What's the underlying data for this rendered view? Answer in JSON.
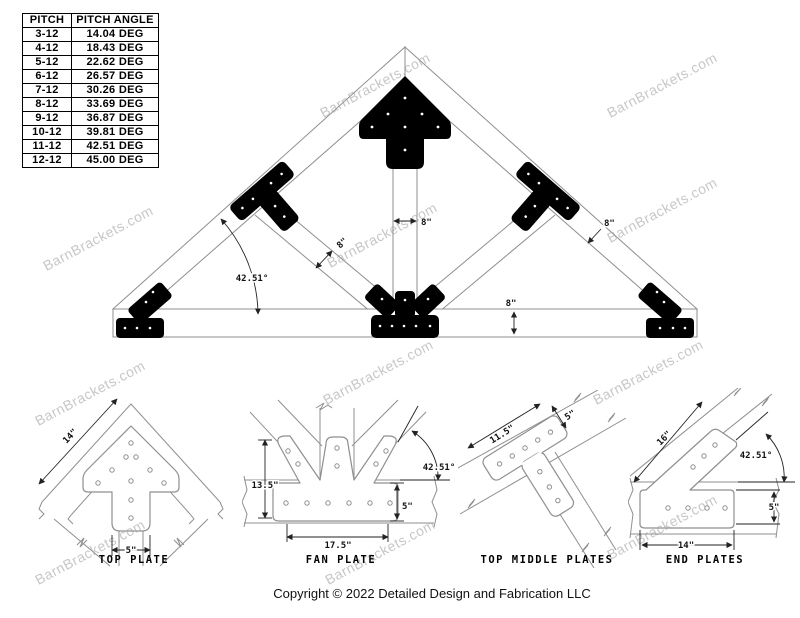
{
  "watermark": {
    "text": "BarnBrackets.com",
    "color": "#c7c7c7"
  },
  "colors": {
    "bracket": "#000000",
    "drawing_line": "#8f8f8f",
    "dimension_text": "#111111"
  },
  "pitch_table": {
    "header_pitch": "PITCH",
    "header_angle": "PITCH ANGLE",
    "rows": [
      {
        "pitch": "3-12",
        "angle": "14.04 DEG"
      },
      {
        "pitch": "4-12",
        "angle": "18.43 DEG"
      },
      {
        "pitch": "5-12",
        "angle": "22.62 DEG"
      },
      {
        "pitch": "6-12",
        "angle": "26.57 DEG"
      },
      {
        "pitch": "7-12",
        "angle": "30.26 DEG"
      },
      {
        "pitch": "8-12",
        "angle": "33.69 DEG"
      },
      {
        "pitch": "9-12",
        "angle": "36.87 DEG"
      },
      {
        "pitch": "10-12",
        "angle": "39.81 DEG"
      },
      {
        "pitch": "11-12",
        "angle": "42.51 DEG"
      },
      {
        "pitch": "12-12",
        "angle": "45.00 DEG"
      }
    ]
  },
  "truss_diagram": {
    "pitch_angle_label": "42.51°",
    "king_post_width": "8\"",
    "strut_width": "8\"",
    "rafter_width": "8\"",
    "bottom_chord_height": "8\""
  },
  "details": {
    "top_plate": {
      "caption": "TOP PLATE",
      "edge_length": "14\"",
      "stem_width": "5\""
    },
    "fan_plate": {
      "caption": "FAN PLATE",
      "height": "13.5\"",
      "base_width": "17.5\"",
      "base_height": "5\"",
      "angle": "42.51°"
    },
    "top_middle_plates": {
      "caption": "TOP MIDDLE PLATES",
      "length": "11.5\"",
      "width": "5\""
    },
    "end_plates": {
      "caption": "END PLATES",
      "arm_length": "16\"",
      "angle": "42.51°",
      "base_height": "5\"",
      "base_width": "14\""
    }
  },
  "footer": {
    "copyright": "Copyright © 2022 Detailed Design and Fabrication LLC"
  }
}
